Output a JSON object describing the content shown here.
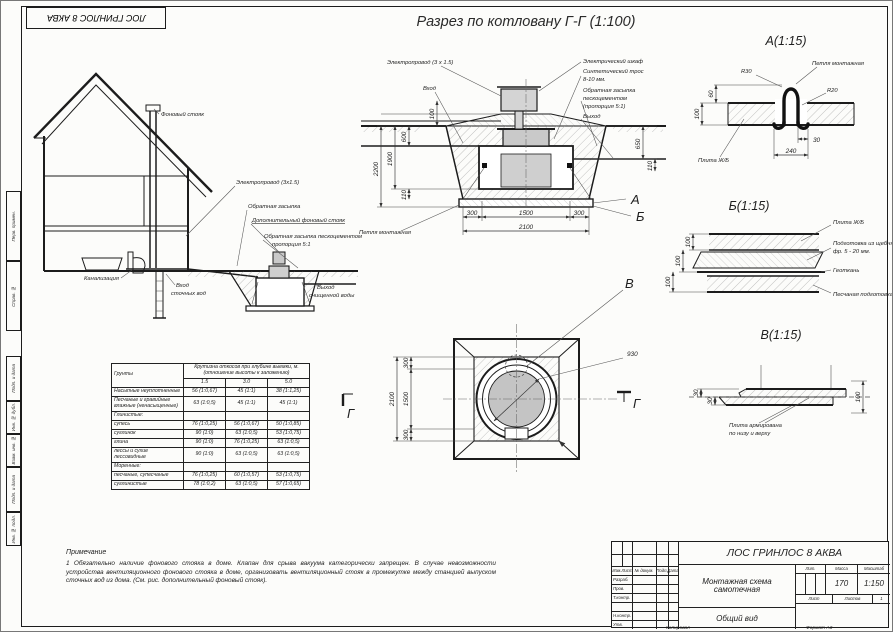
{
  "sheet": {
    "corner_stamp": "ЛОС ГРИНЛОС 8 АКВА",
    "title": "Разрез по котловану Г-Г (1:100)",
    "side_stamp": [
      "Перв. примен.",
      "Справ. №",
      "Подп. и дата",
      "Инв. № дубл.",
      "Взам. инв. №",
      "Подп. и дата",
      "Инв. № подл."
    ]
  },
  "house": {
    "labels": {
      "vent_stack": "Фоновый стояк",
      "cable": "Электропровод (3х1.5)",
      "backfill": "Обратная засыпка",
      "extra_vent": "Дополнительный фоновый стояк",
      "cement_1": "Обратная засыпка пескоцементом",
      "cement_2": "пропорция 5:1",
      "sewer": "Канализация",
      "inlet_1": "Вход",
      "inlet_2": "сточных вод",
      "outlet_1": "Выход",
      "outlet_2": "очищенной воды"
    }
  },
  "pit": {
    "labels": {
      "cable": "Электропровод (3 х 1.5)",
      "inlet": "Вход",
      "cabinet": "Электрический шкаф",
      "rope_1": "Синтетический трос",
      "rope_2": "8-10 мм.",
      "backfill_1": "Обратная засыпка",
      "backfill_2": "пескоцементом",
      "backfill_3": "(пропорция 5:1)",
      "outlet": "Выход",
      "loop": "Петля монтажная"
    },
    "dims": {
      "d100": "100",
      "d600": "600",
      "d1900": "1900",
      "d2200": "2200",
      "d110l": "110",
      "d650": "650",
      "d110r": "110",
      "d300l": "300",
      "d1500": "1500",
      "d300r": "300",
      "d2100": "2100"
    },
    "callout_a": "А",
    "callout_b": "Б"
  },
  "plan": {
    "callout_v": "В",
    "mark": "Г",
    "dims": {
      "d300t": "300",
      "d1500": "1500",
      "d300b": "300",
      "d2100": "2100",
      "d930": "930"
    }
  },
  "detail_a": {
    "title": "А(1:15)",
    "labels": {
      "r30": "R30",
      "r20": "R20",
      "loop": "Петля монтажная",
      "slab": "Плита Ж/Б"
    },
    "dims": {
      "d60": "60",
      "d100": "100",
      "d30": "30",
      "d240": "240"
    }
  },
  "detail_b": {
    "title": "Б(1:15)",
    "labels": {
      "slab": "Плита Ж/Б",
      "gravel_1": "Подготовка из щебня",
      "gravel_2": "фр. 5 - 20 мм.",
      "geo": "Геоткань",
      "sand": "Песчаная подготовка"
    },
    "dims": {
      "d1": "100",
      "d2": "100",
      "d3": "100"
    }
  },
  "detail_v": {
    "title": "В(1:15)",
    "labels": {
      "note_1": "Плита армирована",
      "note_2": "по низу и верху"
    },
    "dims": {
      "d30a": "30",
      "d30b": "30",
      "d100": "100"
    }
  },
  "table": {
    "groups_header": "Грунты",
    "span_header": "Крутизна откосов при глубине выемки, м. (отношение высоты к заложению)",
    "depths": [
      "1.5",
      "3.0",
      "5.0"
    ],
    "rows": [
      {
        "name": "Насыпные неуплотненные",
        "v15": "56 (1:0,67)",
        "v30": "45 (1:1)",
        "v50": "38 (1:1,25)"
      },
      {
        "name": "Песчаные и гравийные влажные (ненасыщенные)",
        "v15": "63 (1:0,5)",
        "v30": "45 (1:1)",
        "v50": "45 (1:1)"
      },
      {
        "name": "Глинистые:",
        "v15": "",
        "v30": "",
        "v50": ""
      },
      {
        "name": "супесь",
        "v15": "76 (1:0,25)",
        "v30": "56 (1:0,67)",
        "v50": "50 (1:0,85)"
      },
      {
        "name": "суглинок",
        "v15": "90 (1:0)",
        "v30": "63 (1:0,5)",
        "v50": "53 (1:0,75)"
      },
      {
        "name": "глина",
        "v15": "90 (1:0)",
        "v30": "76 (1:0,25)",
        "v50": "63 (1:0,5)"
      },
      {
        "name": "лессы и сухие лессовидные",
        "v15": "90 (1:0)",
        "v30": "63 (1:0,5)",
        "v50": "63 (1:0,5)"
      },
      {
        "name": "Моренные:",
        "v15": "",
        "v30": "",
        "v50": ""
      },
      {
        "name": "песчаные, супесчаные",
        "v15": "76 (1:0,25)",
        "v30": "60 (1:0,57)",
        "v50": "53 (1:0,75)"
      },
      {
        "name": "суглинистые",
        "v15": "78 (1:0,2)",
        "v30": "63 (1:0,5)",
        "v50": "57 (1:0,65)"
      }
    ]
  },
  "notes": {
    "heading": "Примечание",
    "item1": "1 Обязательно наличие фонового стояка в доме. Клапан для срыва вакуума категорически запрещен. В случае невозможности устройства вентиляционного фонового стояка в доме, организовать вентиляционный стояк в промежутке между станцией выпуском сточных вод из дома. (См. рис. дополнительный фоновый стояк)."
  },
  "title_block": {
    "product": "ЛОС ГРИНЛОС 8 АКВА",
    "doc_line1": "Монтажная схема",
    "doc_line2": "самотечная",
    "view": "Общий вид",
    "mass": "170",
    "scale": "1:150",
    "h_izm": "Изм.",
    "h_list": "Лист",
    "h_doc": "№ докум.",
    "h_podp": "Подп.",
    "h_data": "Дата",
    "r_razrab": "Разраб.",
    "r_prov": "Пров.",
    "r_tkontr": "Т.контр.",
    "r_nkontr": "Н.контр.",
    "r_utv": "Утв.",
    "h_lit": "Лит.",
    "h_mass": "Масса",
    "h_scale": "Масштаб",
    "h_sheet": "Лист",
    "h_sheets": "Листов",
    "sheets_val": "1",
    "copied": "Копировал",
    "format": "Формат А3"
  }
}
